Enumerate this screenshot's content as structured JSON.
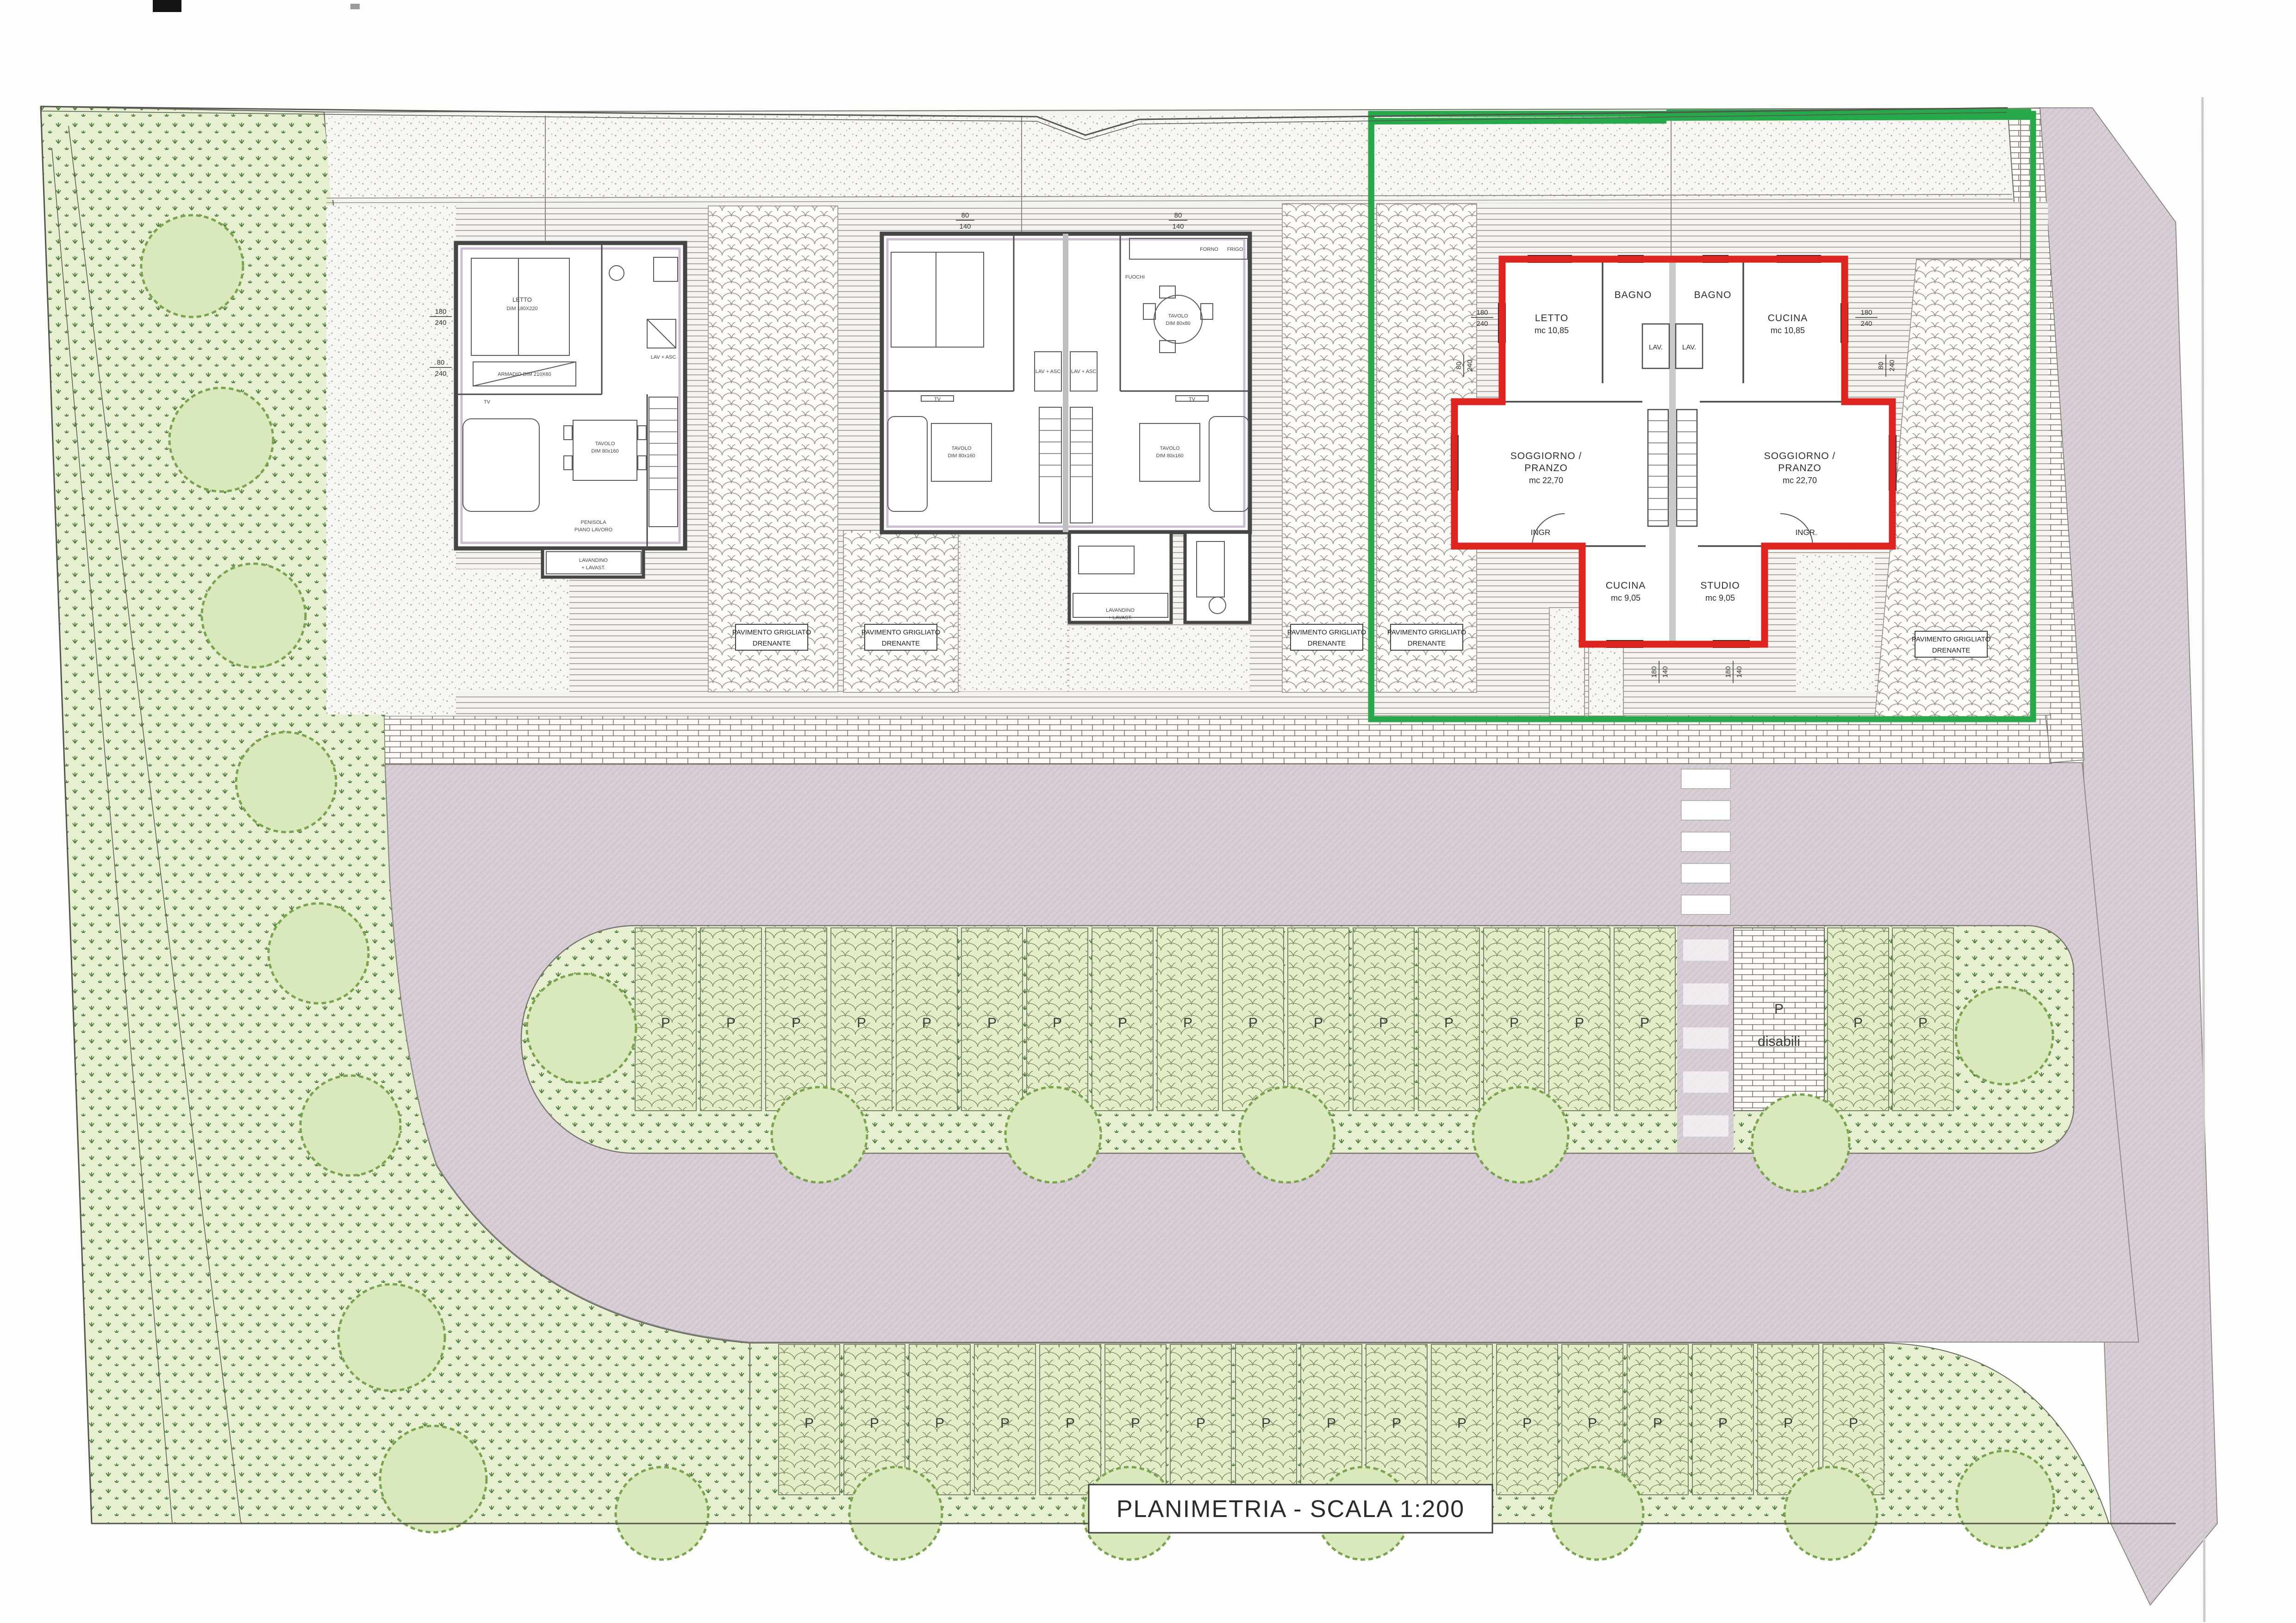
{
  "page": {
    "title": "PLANIMETRIA - SCALA 1:200"
  },
  "labels": {
    "pavimento_line1": "PAVIMENTO GRIGLIATO",
    "pavimento_line2": "DRENANTE"
  },
  "parking": {
    "stall_label": "P",
    "disabled_line1": "P",
    "disabled_line2": "disabili",
    "row1_regular_count": 16,
    "row1_extra_count": 2,
    "row2_count": 17
  },
  "building3": {
    "left": {
      "room1": "LETTO",
      "room1_vol": "mc 10,85",
      "bath": "BAGNO",
      "lav": "LAV.",
      "living1": "SOGGIORNO /",
      "living2": "PRANZO",
      "living_vol": "mc 22,70",
      "entry": "INGR",
      "room2": "CUCINA",
      "room2_vol": "mc 9,05"
    },
    "right": {
      "bath": "BAGNO",
      "room1": "CUCINA",
      "room1_vol": "mc 10,85",
      "lav": "LAV.",
      "living1": "SOGGIORNO /",
      "living2": "PRANZO",
      "living_vol": "mc 22,70",
      "entry": "INGR.",
      "room2": "STUDIO",
      "room2_vol": "mc 9,05"
    }
  },
  "furniture": {
    "letto": "LETTO",
    "letto_dim": "DIM 180X220",
    "armadio": "ARMADIO DIM 210X60",
    "tv": "TV",
    "tavolo": "TAVOLO",
    "tavolo_dim": "DIM 80x160",
    "tavolo80": "TAVOLO",
    "tavolo80_dim": "DIM 80x80",
    "penisola1": "PENISOLA",
    "penisola2": "PIANO LAVORO",
    "lavandino1": "LAVANDINO",
    "lavandino2": "+ LAVAST.",
    "lav_asc": "LAV + ASC",
    "fuochi": "FUOCHI",
    "forno": "FORNO",
    "frigo": "FRIGO"
  },
  "dims": {
    "d180": "180",
    "d240": "240",
    "d80": "80",
    "d140": "140"
  },
  "colors": {
    "green_highlight": "#27a94b",
    "red_outline": "#dd2420",
    "road": "#d8ced6",
    "grass": "#e6efcf",
    "stall_green": "#e3eec8",
    "tree": "#d9e9bc",
    "brick_bg": "#fcfbf8"
  }
}
